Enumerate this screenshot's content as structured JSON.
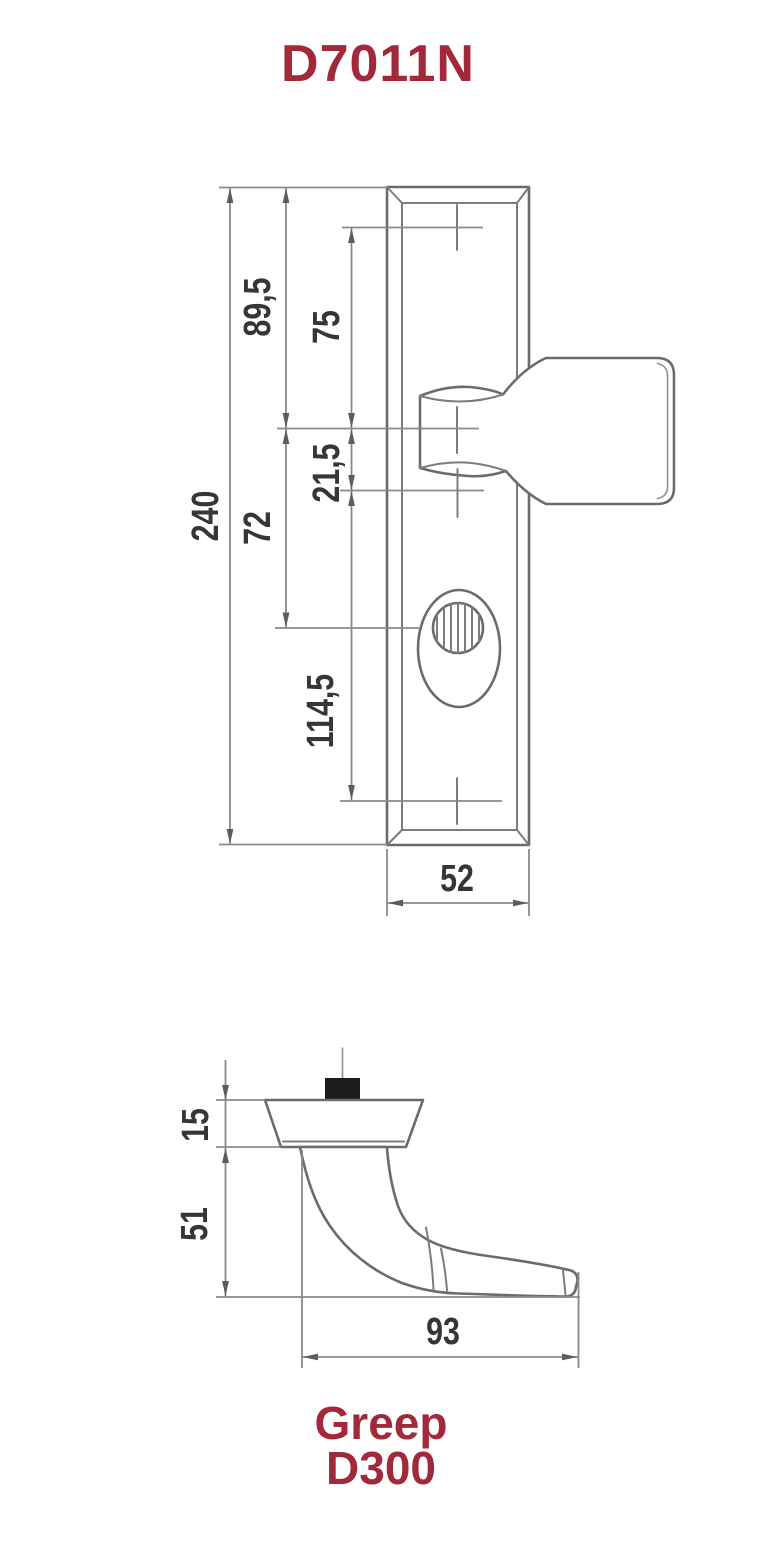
{
  "title": "D7011N",
  "front_view": {
    "dim_plate_height": "240",
    "dim_plate_top_to_handle_center": "89,5",
    "dim_top_hole_to_handle_center": "75",
    "dim_handle_center_to_lower_hole": "21,5",
    "dim_handle_center_to_cylinder": "72",
    "dim_lower_hole_to_bottom_hole": "114,5",
    "dim_plate_width": "52"
  },
  "side_view": {
    "dim_rose_thickness": "15",
    "dim_handle_projection": "51",
    "dim_handle_length": "93"
  },
  "caption": {
    "line1": "Greep",
    "line2": "D300"
  },
  "colors": {
    "accent_red": "#A2293A",
    "line_gray": "#6b6b6b",
    "dim_gray": "#8a8a8a",
    "label_gray": "#363636"
  }
}
